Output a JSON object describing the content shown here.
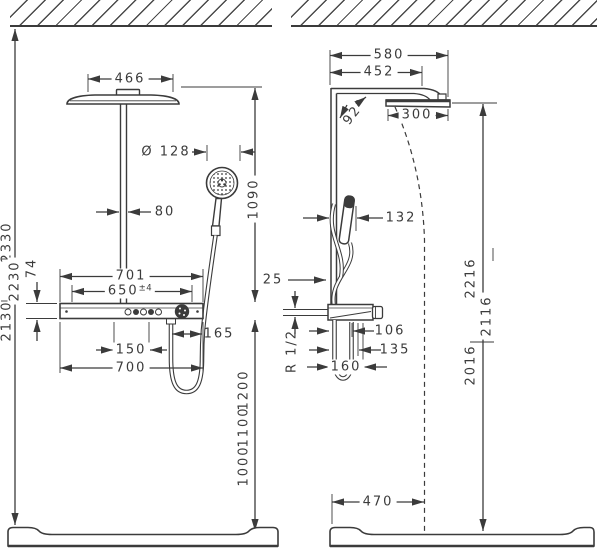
{
  "drawing": {
    "front_view": {
      "head_width": "466",
      "hand_shower_diameter": "Ø 128",
      "pipe_width": "80",
      "head_to_shelf": "1090",
      "ceiling_height_max": "2330",
      "ceiling_height_mid": "2230",
      "ceiling_height_min": "2130",
      "shelf_thickness": "74",
      "shelf_width_outer": "701",
      "shelf_width_inner": "650",
      "shelf_width_tolerance": "±4",
      "hose_outlet_offset": "165",
      "control_spacing": "150",
      "shelf_width_bottom": "700",
      "install_height_high": "1200",
      "install_height_mid": "1100",
      "install_height_low": "1000"
    },
    "side_view": {
      "overall_depth": "580",
      "arm_depth": "452",
      "arm_angle": "92°",
      "head_depth": "300",
      "hand_shower_offset": "132",
      "bar_wall_gap": "25",
      "total_height_top": "2216",
      "total_height_mid": "2116",
      "total_height_low": "2016",
      "shelf_depth_small": "106",
      "shelf_depth_mid": "135",
      "connection_thread": "R 1/2",
      "shelf_depth_large": "160",
      "tray_depth": "470"
    }
  }
}
